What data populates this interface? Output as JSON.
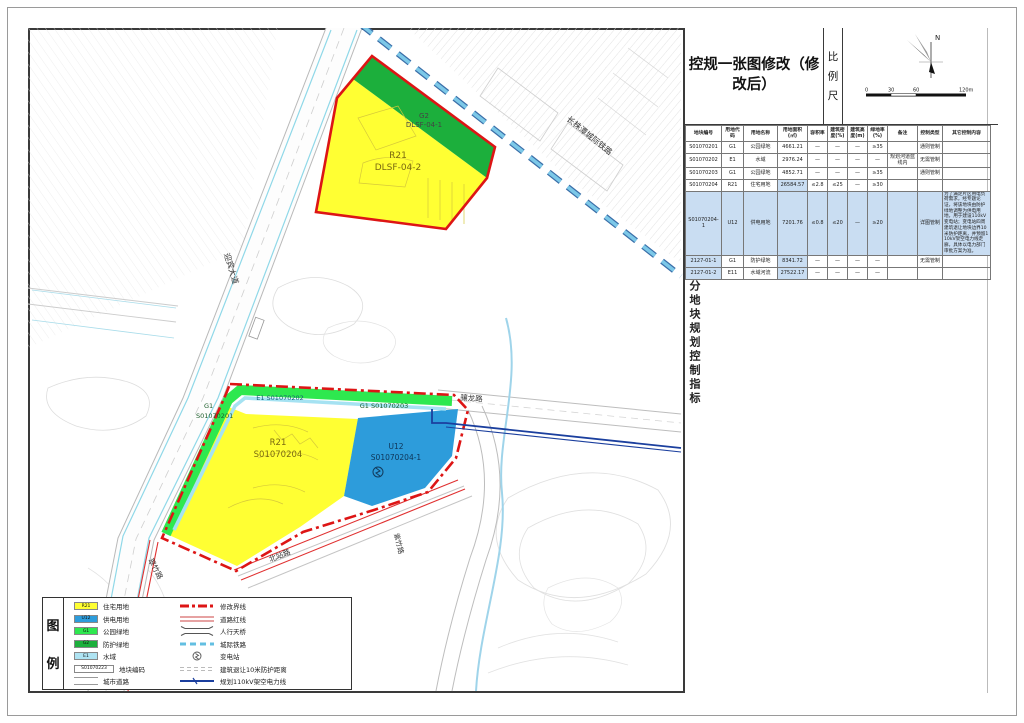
{
  "sheet": {
    "title": "控规一张图修改（修改后）",
    "scale_label": "比例尺",
    "north": "N",
    "scale_ticks": [
      "0",
      "30",
      "60",
      "120m"
    ],
    "side_caption": "分地块规划控制指标"
  },
  "map": {
    "roads": {
      "yingbin": "迎宾大道",
      "railway": "长株潭城际铁路",
      "xianglong": "骧龙路",
      "cuizhu": "翠竹路",
      "beizhan": "北站路",
      "zizhu": "紫竹路"
    },
    "parcels": {
      "p1_code": "G2",
      "p1_id": "DLSF-04-1",
      "p2_code": "R21",
      "p2_id": "DLSF-04-2",
      "p3_code": "G1",
      "p3_id": "S01070201",
      "p4": "E1 S01070202",
      "p5": "G1 S01070203",
      "p6_code": "R21",
      "p6_id": "S01070204",
      "p7_code": "U12",
      "p7_id": "S01070204-1"
    }
  },
  "table": {
    "columns": [
      "地块编号",
      "用地代码",
      "用地名称",
      "用地面积(㎡)",
      "容积率",
      "建筑密度(%)",
      "建筑高度(m)",
      "绿地率(%)",
      "备注",
      "控制类型",
      "其它控制内容"
    ],
    "rows": [
      {
        "cells": [
          "S01070201",
          "G1",
          "公园绿地",
          "4661.21",
          "—",
          "—",
          "—",
          "≥35",
          "",
          "通则管制",
          ""
        ],
        "hl": [],
        "tall": false
      },
      {
        "cells": [
          "S01070202",
          "E1",
          "水域",
          "2976.24",
          "—",
          "—",
          "—",
          "—",
          "规划河道蓝线内",
          "无需管制",
          ""
        ],
        "hl": [],
        "tall": false
      },
      {
        "cells": [
          "S01070203",
          "G1",
          "公园绿地",
          "4852.71",
          "—",
          "—",
          "—",
          "≥35",
          "",
          "通则管制",
          ""
        ],
        "hl": [],
        "tall": false
      },
      {
        "cells": [
          "S01070204",
          "R21",
          "住宅用地",
          "26584.57",
          "≤2.8",
          "≤25",
          "—",
          "≥30",
          "",
          "",
          ""
        ],
        "hl": [
          3
        ],
        "tall": false
      },
      {
        "cells": [
          "S01070204-1",
          "U12",
          "供电用地",
          "7201.76",
          "≤0.8",
          "≤20",
          "—",
          "≥20",
          "",
          "详图管制",
          "为了满足片区用电负荷需求，经专题论证，将该地块由防护绿地调整为供电用地，用于建设110kV变电站；变电站四周建筑退让地块边界10米防护距离，并预留110kV架空电力线走廊，具体以电力部门审批方案为准。"
        ],
        "hl": [
          0,
          1,
          2,
          3,
          4,
          5,
          6,
          7,
          8,
          9,
          10
        ],
        "tall": true
      },
      {
        "cells": [
          "2127-01-1",
          "G1",
          "防护绿地",
          "8341.72",
          "—",
          "—",
          "—",
          "—",
          "",
          "无需管制",
          ""
        ],
        "hl": [
          0,
          3
        ],
        "tall": false
      },
      {
        "cells": [
          "2127-01-2",
          "E11",
          "水域河流",
          "27522.17",
          "—",
          "—",
          "—",
          "—",
          "",
          "",
          ""
        ],
        "hl": [
          0,
          3
        ],
        "tall": false
      }
    ]
  },
  "legend": {
    "caption": [
      "图",
      "例"
    ],
    "left": [
      {
        "code": "R21",
        "color": "#ffff33",
        "label": "住宅用地"
      },
      {
        "code": "U12",
        "color": "#2d9cdb",
        "label": "供电用地"
      },
      {
        "code": "G1",
        "color": "#2ee84f",
        "label": "公园绿地"
      },
      {
        "code": "G2",
        "color": "#1caf3c",
        "label": "防护绿地"
      },
      {
        "code": "E1",
        "color": "#aee3f2",
        "label": "水域"
      },
      {
        "code": "S01070223",
        "color": "#ffffff",
        "label": "地块编码",
        "wide": true
      },
      {
        "code": "",
        "color": "#ffffff",
        "label": "城市道路",
        "road": true
      }
    ],
    "right": [
      {
        "symbol": "boundary-line",
        "label": "修改界线"
      },
      {
        "symbol": "setback-line",
        "label": "道路红线"
      },
      {
        "symbol": "footbridge",
        "label": "人行天桥"
      },
      {
        "symbol": "intercity-rail",
        "label": "城际铁路"
      },
      {
        "symbol": "substation",
        "label": "变电站"
      },
      {
        "symbol": "protect-dist",
        "label": "建筑退让10米防护距离"
      },
      {
        "symbol": "power-line",
        "label": "规划110kV架空电力线"
      }
    ]
  },
  "colors": {
    "residential": "#ffff33",
    "power": "#2d9cdb",
    "park_green": "#2ee84f",
    "protect_green": "#1caf3c",
    "water": "#aee3f2",
    "boundary_red": "#dd1515",
    "railway_blue": "#63bfe2",
    "powerline_navy": "#1b3f9e"
  }
}
